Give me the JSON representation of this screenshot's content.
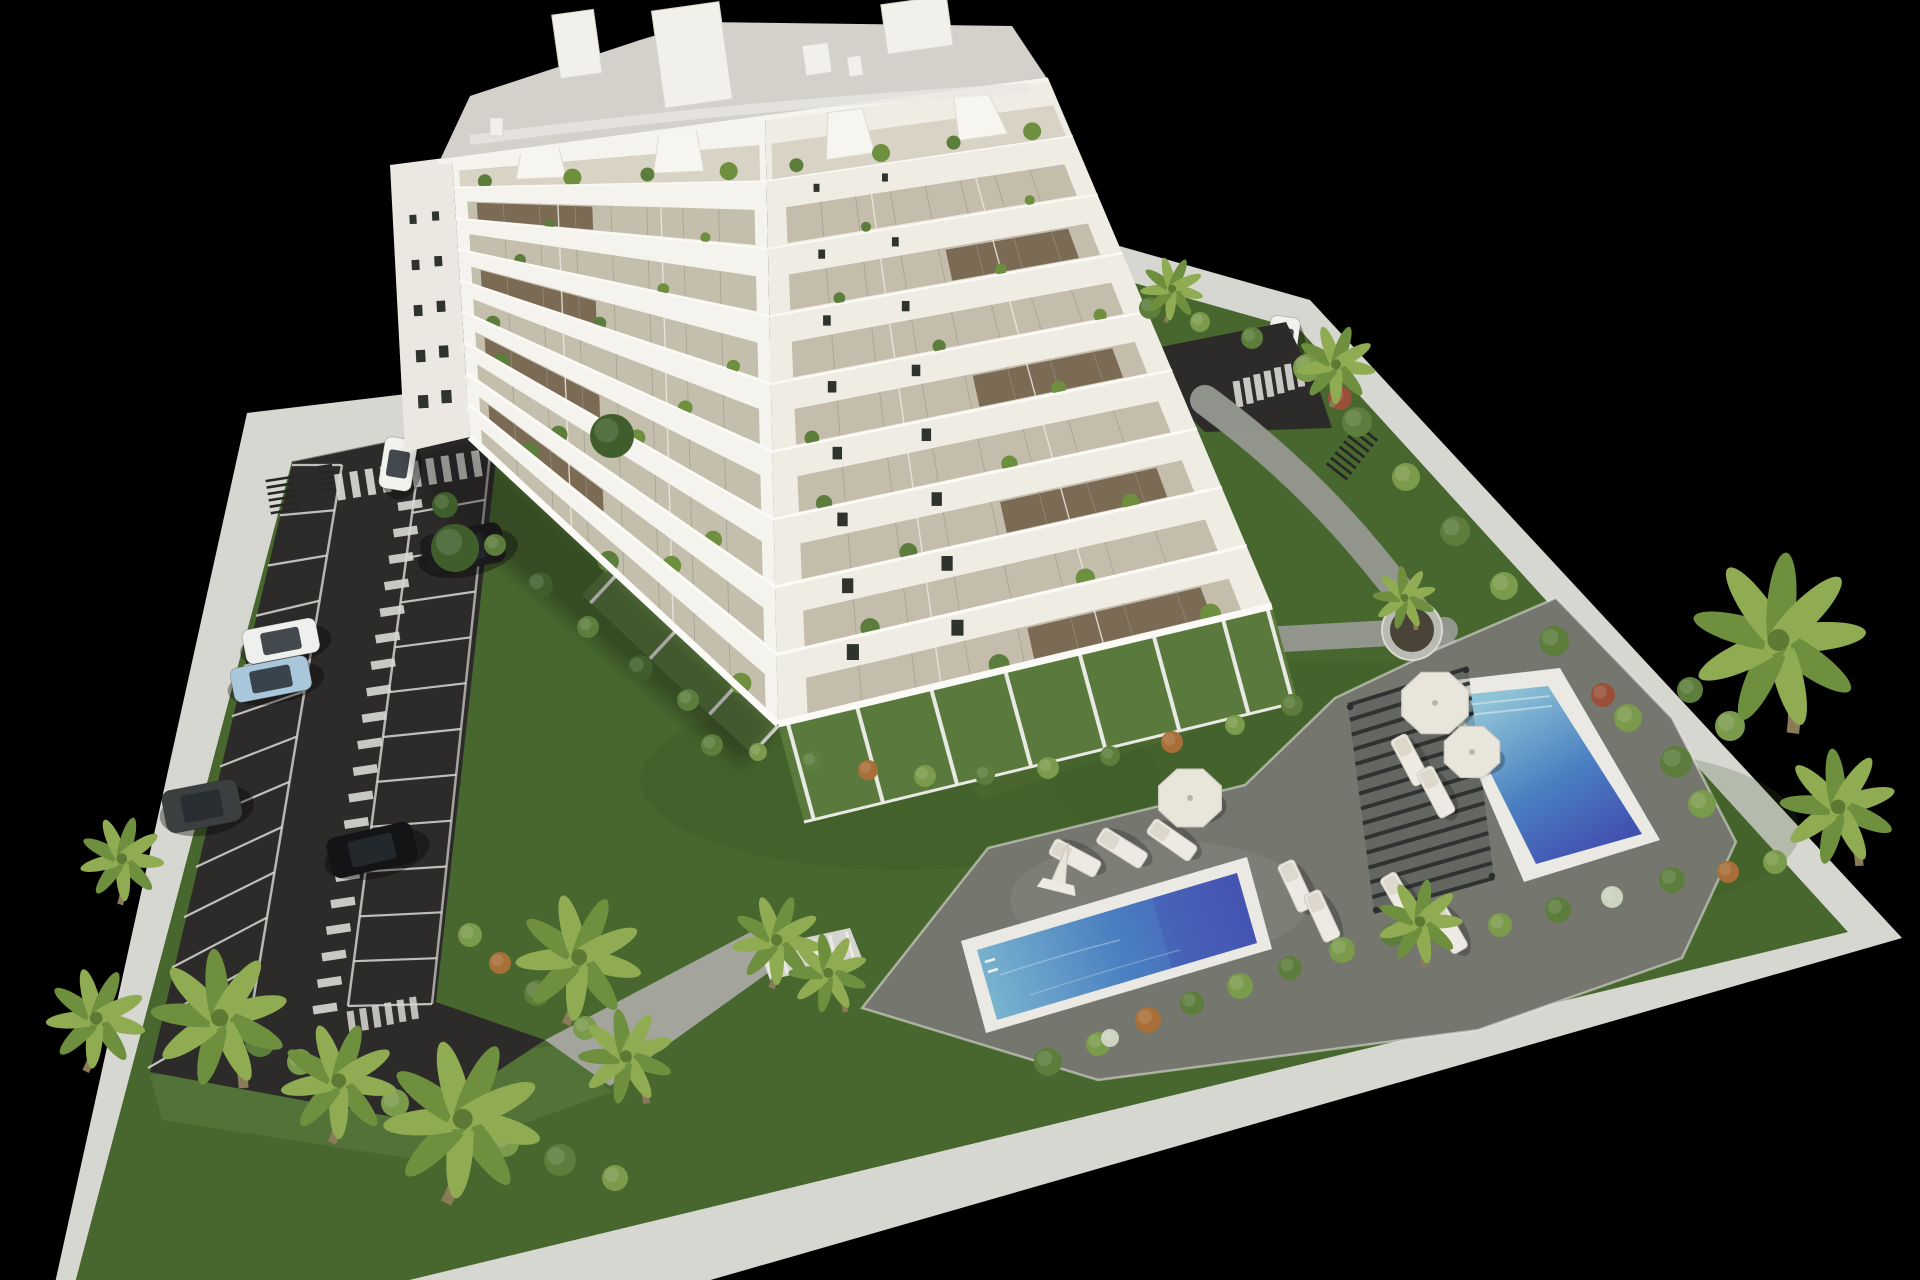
{
  "scene": {
    "title": "Aerial 3D render of a residential complex",
    "description": "Bird's-eye photorealistic architectural visualization: white multi-storey apartment building with balconies and penthouse terraces, asphalt parking lot with marked stalls and crosswalks, landscaped lawns with palm trees and shrubs, two rectangular swimming pools with sun loungers, parasols and a slatted pergola, all enclosed by a light concrete perimeter wall on a black background",
    "style": "photorealistic 3D render, isometric aerial view",
    "background_color": "#000000",
    "building": {
      "floors_visible": 9,
      "penthouse_terraces": true,
      "balconies_with_glass_railings": true,
      "balcony_plants": true,
      "roof_access_boxes": 4,
      "facade_color": "#f5f3ed"
    },
    "parking": {
      "surface": "dark asphalt",
      "stall_columns": 2,
      "stall_lines": 12,
      "pedestrian_walkway_stripes": 20,
      "crosswalks": 3,
      "bike_racks": 3,
      "cars": [
        {
          "name": "white-hatchback",
          "color": "#f2f2ee",
          "x": 398,
          "y": 464,
          "w": 33,
          "h": 52,
          "rot": 9
        },
        {
          "name": "black-sedan",
          "color": "#1c1c1e",
          "x": 463,
          "y": 549,
          "w": 82,
          "h": 40,
          "rot": -12
        },
        {
          "name": "white-coupe",
          "color": "#eff0ee",
          "x": 281,
          "y": 641,
          "w": 75,
          "h": 35,
          "rot": -11
        },
        {
          "name": "light-blue-sedan",
          "color": "#a9c7da",
          "x": 271,
          "y": 679,
          "w": 79,
          "h": 35,
          "rot": -11
        },
        {
          "name": "dark-gray-suv",
          "color": "#3c3f40",
          "x": 202,
          "y": 806,
          "w": 77,
          "h": 43,
          "rot": -11
        },
        {
          "name": "black-sedan-2",
          "color": "#141416",
          "x": 372,
          "y": 850,
          "w": 87,
          "h": 41,
          "rot": -13
        },
        {
          "name": "white-city-car",
          "color": "#f1f1ed",
          "x": 1283,
          "y": 340,
          "w": 30,
          "h": 47,
          "rot": 8
        }
      ]
    },
    "pool_area": {
      "pools": [
        {
          "name": "main-pool",
          "shape": "rectangular",
          "water": "blue gradient"
        },
        {
          "name": "secondary-pool",
          "shape": "rectangular",
          "water": "blue gradient"
        }
      ],
      "pergola_count": 1,
      "sun_loungers": [
        [
          1075,
          858,
          -62
        ],
        [
          1122,
          848,
          -58
        ],
        [
          1172,
          840,
          -55
        ],
        [
          1296,
          886,
          -25
        ],
        [
          1322,
          916,
          -25
        ],
        [
          1410,
          760,
          -28
        ],
        [
          1436,
          792,
          -28
        ],
        [
          1400,
          898,
          -30
        ],
        [
          1448,
          928,
          -30
        ]
      ],
      "parasols": [
        [
          1190,
          798,
          34
        ],
        [
          1435,
          703,
          36
        ],
        [
          1472,
          752,
          30
        ]
      ],
      "folded_parasol": [
        1062,
        868
      ],
      "round_planter": [
        1412,
        630
      ],
      "garden_stairs": 1
    },
    "vegetation": {
      "palm_trees": [
        [
          118,
          895,
          0.8
        ],
        [
          85,
          1060,
          0.95
        ],
        [
          235,
          1075,
          1.3
        ],
        [
          330,
          1130,
          1.1
        ],
        [
          445,
          1185,
          1.5
        ],
        [
          565,
          1010,
          1.2
        ],
        [
          640,
          1095,
          0.9
        ],
        [
          770,
          978,
          0.85
        ],
        [
          840,
          1005,
          0.75
        ],
        [
          1420,
          958,
          0.8
        ],
        [
          1785,
          715,
          1.65
        ],
        [
          1852,
          855,
          1.1
        ],
        [
          1412,
          624,
          0.6
        ],
        [
          1330,
          398,
          0.75
        ],
        [
          1165,
          315,
          0.6
        ]
      ],
      "bushes": {
        "parking_edge": [
          [
            260,
            1042,
            15,
            "g1"
          ],
          [
            300,
            1062,
            13,
            "g2"
          ],
          [
            345,
            1082,
            16,
            "g1"
          ],
          [
            395,
            1103,
            14,
            "g2"
          ],
          [
            448,
            1122,
            17,
            "g1"
          ],
          [
            505,
            1143,
            14,
            "g2"
          ],
          [
            560,
            1160,
            16,
            "g1"
          ],
          [
            615,
            1178,
            13,
            "g2"
          ],
          [
            470,
            935,
            12,
            "g2"
          ],
          [
            500,
            963,
            11,
            "or"
          ],
          [
            537,
            993,
            13,
            "g1"
          ],
          [
            585,
            1028,
            12,
            "g2"
          ]
        ],
        "building_side": [
          [
            445,
            505,
            13,
            "dk"
          ],
          [
            495,
            545,
            11,
            "g1"
          ],
          [
            540,
            585,
            13,
            "dk"
          ],
          [
            588,
            627,
            11,
            "g1"
          ],
          [
            640,
            668,
            13,
            "dk"
          ],
          [
            688,
            700,
            11,
            "g1"
          ],
          [
            455,
            548,
            24,
            "dk"
          ],
          [
            612,
            436,
            22,
            "dk"
          ]
        ],
        "terrace_row": [
          [
            712,
            745,
            11,
            "g1"
          ],
          [
            758,
            752,
            9,
            "g2"
          ],
          [
            812,
            762,
            11,
            "g1"
          ],
          [
            868,
            770,
            10,
            "or"
          ],
          [
            925,
            776,
            11,
            "g2"
          ],
          [
            985,
            775,
            10,
            "g1"
          ],
          [
            1048,
            768,
            11,
            "g2"
          ],
          [
            1110,
            756,
            10,
            "g1"
          ],
          [
            1172,
            742,
            11,
            "or"
          ],
          [
            1235,
            725,
            10,
            "g2"
          ],
          [
            1292,
            705,
            11,
            "g1"
          ]
        ],
        "deck_row": [
          [
            1048,
            1062,
            14,
            "g1"
          ],
          [
            1098,
            1044,
            12,
            "g2"
          ],
          [
            1110,
            1038,
            9,
            "wh"
          ],
          [
            1148,
            1020,
            13,
            "or"
          ],
          [
            1192,
            1003,
            12,
            "g1"
          ],
          [
            1240,
            986,
            13,
            "g2"
          ],
          [
            1290,
            968,
            12,
            "g1"
          ],
          [
            1342,
            950,
            13,
            "g2"
          ],
          [
            1392,
            935,
            11,
            "g1"
          ],
          [
            1500,
            925,
            12,
            "g2"
          ],
          [
            1558,
            910,
            13,
            "g1"
          ],
          [
            1612,
            897,
            11,
            "wh"
          ],
          [
            1672,
            880,
            13,
            "g1"
          ],
          [
            1728,
            872,
            11,
            "or"
          ],
          [
            1775,
            862,
            12,
            "g2"
          ]
        ],
        "wall_row": [
          [
            1150,
            308,
            11,
            "g1"
          ],
          [
            1200,
            322,
            10,
            "g2"
          ],
          [
            1252,
            338,
            11,
            "g1"
          ],
          [
            1307,
            368,
            14,
            "g2"
          ],
          [
            1340,
            398,
            12,
            "rd"
          ],
          [
            1357,
            422,
            15,
            "g1"
          ],
          [
            1406,
            477,
            14,
            "g2"
          ],
          [
            1455,
            531,
            15,
            "g1"
          ],
          [
            1504,
            586,
            14,
            "g2"
          ],
          [
            1554,
            641,
            15,
            "g1"
          ],
          [
            1603,
            695,
            12,
            "rd"
          ],
          [
            1628,
            718,
            14,
            "g2"
          ],
          [
            1676,
            762,
            16,
            "g1"
          ],
          [
            1702,
            804,
            14,
            "g2"
          ],
          [
            1690,
            690,
            13,
            "g1"
          ],
          [
            1730,
            726,
            15,
            "g2"
          ]
        ]
      }
    },
    "colors": {
      "bg": "#000000",
      "wall": "#d7d7d2",
      "wallEdge": "#e9e9e4",
      "grass": "#47672e",
      "grassLight": "#567539",
      "grassDark": "#3a5726",
      "asphalt": "#2d2b2a",
      "marking": "#d9d9d4",
      "path": "#969891",
      "ramp": "#a3a59d",
      "deck": "#75776f",
      "coping": "#eae9e4",
      "waterShallow": "#85bcd2",
      "water": "#4a7fc1",
      "waterDeep": "#4653b2",
      "pergola": "#2b2e2c",
      "lounger": "#eceae2",
      "cushion": "#dcd8cc",
      "umbrella": "#e8e5db",
      "building": "#f5f3ed",
      "buildingShade": "#efece4",
      "buildingEnd": "#eae8e0",
      "slab": "#fbfaf6",
      "glass": "#c1bba9",
      "recess": "#69563f",
      "windowDark": "#2e332e",
      "roof": "#d3d1ca",
      "roofBox": "#f2f0ea",
      "terrace": "#5a7a3d",
      "terraceFloor": "#d8d3c4",
      "trunk": "#8a7a58",
      "palm1": "#8fac52",
      "palm2": "#6d8f3e",
      "g1": "#5c7d3c",
      "g2": "#7a9a4c",
      "dk": "#3f5e2b",
      "or": "#a86f38",
      "rd": "#9a5038",
      "wh": "#ccd3bf",
      "carGlass": "#262b31",
      "planterRim": "#b9bbb3",
      "soil": "#4a4438",
      "stairTread": "#d5d5cf"
    }
  }
}
